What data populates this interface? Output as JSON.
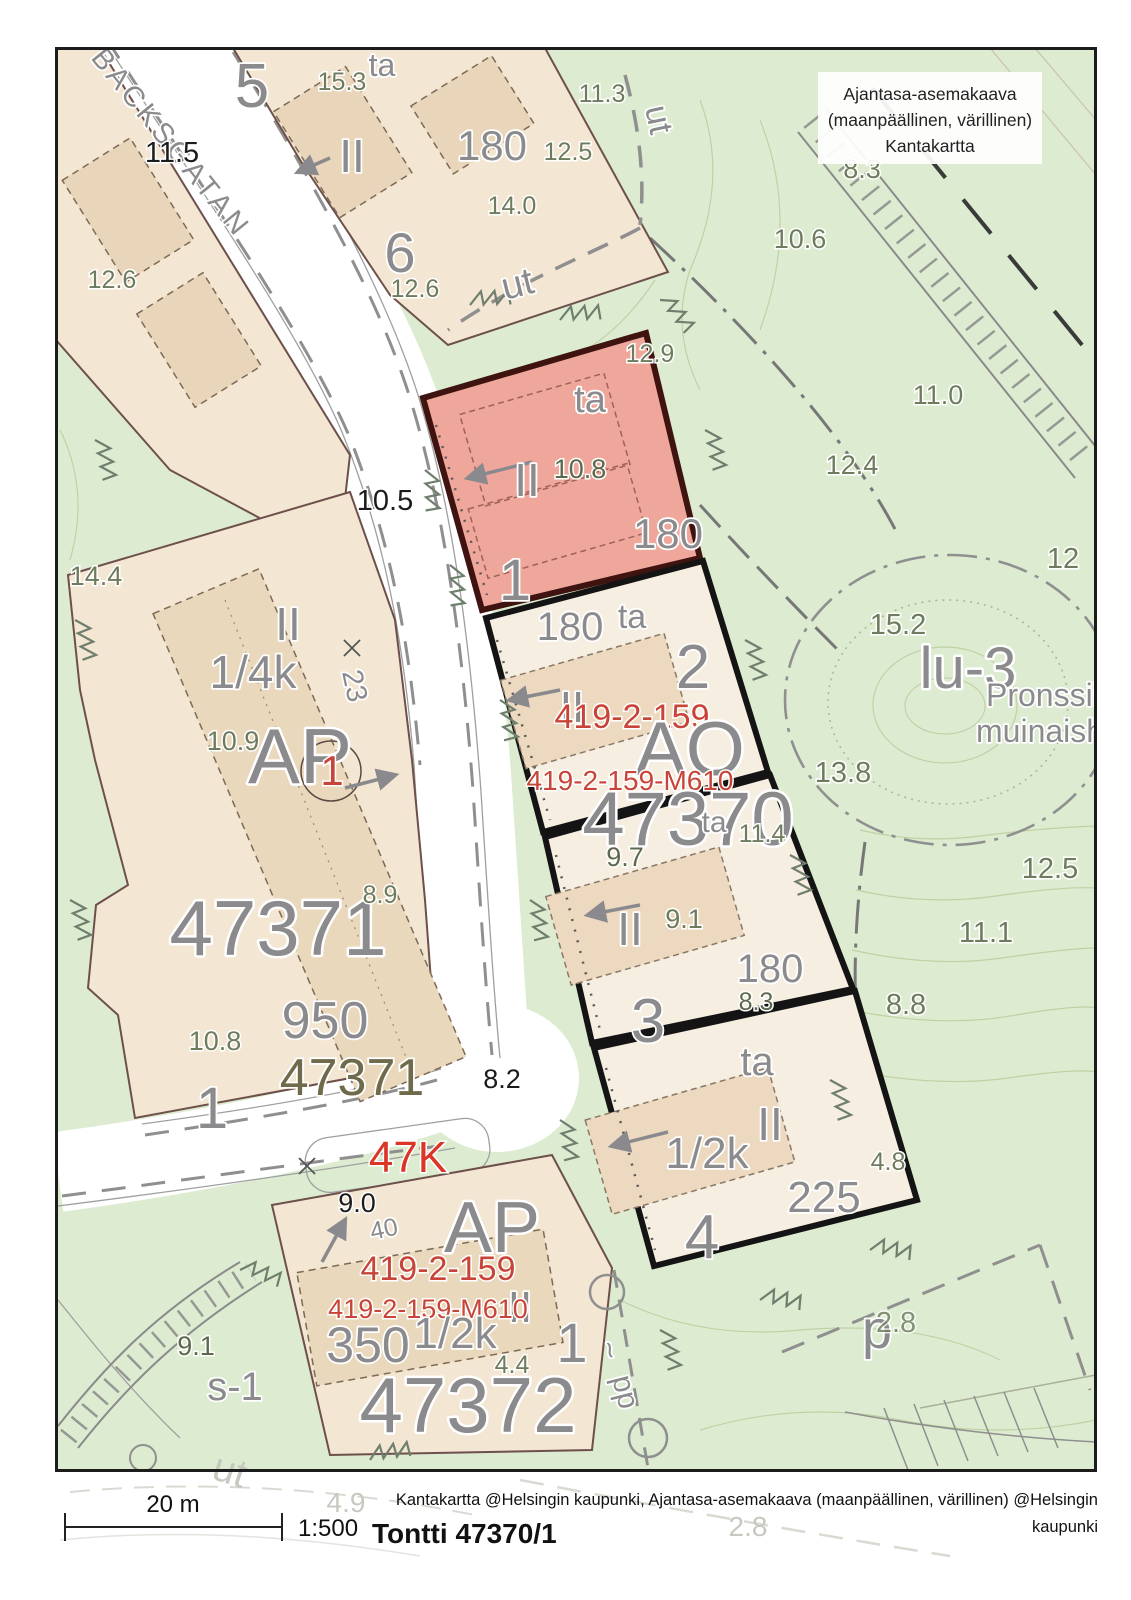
{
  "legend": {
    "line1": "Ajantasa-asemakaava",
    "line2": "(maanpäällinen, värillinen)",
    "line3": "Kantakartta"
  },
  "footer": {
    "scale_label": "20 m",
    "scale_ratio": "1:500",
    "title": "Tontti 47370/1",
    "credit_line1": "Kantakartta @Helsingin kaupunki, Ajantasa-asemakaava (maanpäällinen, värillinen) @Helsingin",
    "credit_line2": "kaupunki"
  },
  "colors": {
    "map_green": "#ddecd1",
    "parcel_tan": "#f3e6d2",
    "building_tan": "#e9d6ba",
    "plot_cream": "#f7eee2",
    "highlight_red": "#efa79c",
    "plot_border_black": "#141414",
    "highlight_border": "#3f1310",
    "label_gray": "#8b8b8e",
    "label_olive": "#6e7b5c",
    "label_red": "#c84438"
  },
  "map": {
    "labels": {
      "street": "BACKSGATAN",
      "blk5": "5",
      "e15_3": "15.3",
      "ta_top": "ta",
      "w11_5": "11.5",
      "ii_top": "II",
      "a180_top": "180",
      "e12_5": "12.5",
      "e14_0": "14.0",
      "e11_3": "11.3",
      "ut_v": "ut",
      "e12_6a": "12.6",
      "blk6": "6",
      "e12_6b": "12.6",
      "ut_h": "ut",
      "e10_6": "10.6",
      "e8_3": "8.3",
      "e11_0": "11.0",
      "e12_4": "12.4",
      "e12_9": "12.9",
      "p1_ta": "ta",
      "p1_ii": "II",
      "p1_10_8": "10.8",
      "p1_180": "180",
      "p1_no": "1",
      "p2_180": "180",
      "p2_ta": "ta",
      "p2_no": "2",
      "p2_ii": "II",
      "p2_reg": "419-2-159",
      "p2_ao": "AO",
      "p2_reg2": "419-2-159-M610",
      "p2_47370": "47370",
      "p3_9_7": "9.7",
      "p3_ta": "ta",
      "p3_11_4": "11.4",
      "p3_ii": "II",
      "p3_9_1": "9.1",
      "p3_180": "180",
      "p3_8_3": "8.3",
      "p3_no": "3",
      "p4_ta": "ta",
      "p4_ii": "II",
      "p4_12k": "1/2k",
      "p4_225": "225",
      "p4_no": "4",
      "p4_4_8": "4.8",
      "e14_4": "14.4",
      "ap1_ii": "II",
      "ap1_14k": "1/4k",
      "ap1_10_9": "10.9",
      "ap1_ap": "AP",
      "ap1_red1": "1",
      "ap1_23": "23",
      "ap1_47371": "47371",
      "ap1_8_9": "8.9",
      "ap1_950": "950",
      "ap1_10_8": "10.8",
      "ap1_47371b": "47371",
      "ap1_no": "1",
      "road_10_5": "10.5",
      "road_8_2": "8.2",
      "road_47k": "47K",
      "road_9_0": "9.0",
      "ap2_40": "40",
      "ap2_ap": "AP",
      "ap2_reg": "419-2-159",
      "ap2_ii": "II",
      "ap2_reg2": "419-2-159-M610",
      "ap2_12k": "1/2k",
      "ap2_350": "350",
      "ap2_4_4": "4.4",
      "ap2_no": "1",
      "ap2_47372": "47372",
      "s1": "s-1",
      "e9_1": "9.1",
      "p_label": "p",
      "e2_8": "2.8",
      "pp": "pp",
      "pp_tilde": "~",
      "lu3": "lu-3",
      "lu3_sub1": "Pronssika",
      "lu3_sub2": "muinaisha",
      "e15_2": "15.2",
      "e13_8": "13.8",
      "e12r": "12",
      "e12_5r": "12.5",
      "e11_1": "11.1",
      "e8_8": "8.8",
      "faded_ut": "ut",
      "faded_4_9": "4.9",
      "faded_2_8": "2.8"
    }
  }
}
